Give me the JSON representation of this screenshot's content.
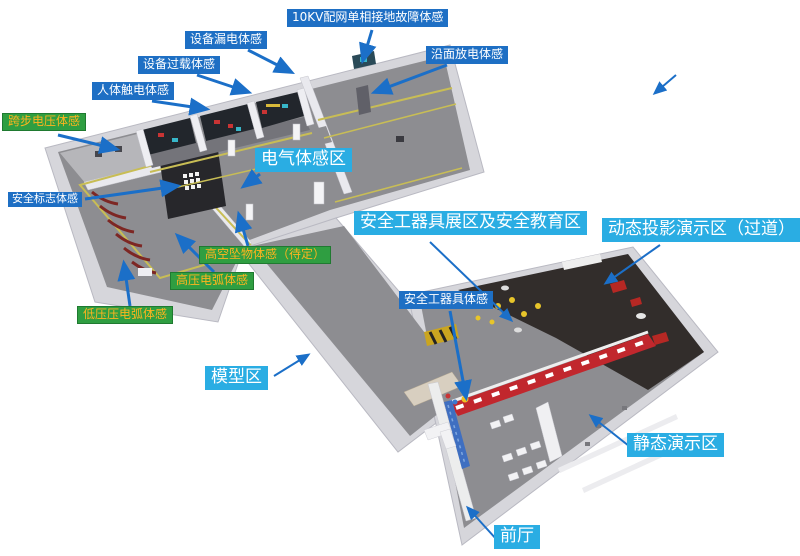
{
  "palette": {
    "label_blue": "#1e6fc4",
    "label_cyan": "#2aade3",
    "label_green": "#2f9e41",
    "green_label_text": "#ffb41e",
    "arrow_blue": "#1b6fc8",
    "floor_gray": "#8d8d91",
    "dark_floor": "#322d2b",
    "wall_white": "#d6d6db",
    "red_display_wall": "#c1272d",
    "floor_line_yellow": "#c8bd55"
  },
  "labels": {
    "kv10_fault": {
      "text": "10KV配网单相接地故障体感",
      "type": "blue"
    },
    "equipment_leakage": {
      "text": "设备漏电体感",
      "type": "blue"
    },
    "equipment_overload": {
      "text": "设备过载体感",
      "type": "blue"
    },
    "human_electric_shock": {
      "text": "人体触电体感",
      "type": "blue"
    },
    "surface_discharge": {
      "text": "沿面放电体感",
      "type": "blue"
    },
    "step_voltage": {
      "text": "跨步电压体感",
      "type": "green"
    },
    "safety_sign": {
      "text": "安全标志体感",
      "type": "blue"
    },
    "electric_zone": {
      "text": "电气体感区",
      "type": "cyan"
    },
    "falling_object": {
      "text": "高空坠物体感（待定）",
      "type": "green"
    },
    "high_voltage_arc": {
      "text": "高压电弧体感",
      "type": "green"
    },
    "low_voltage_arc": {
      "text": "低压压电弧体感",
      "type": "green"
    },
    "tools_exhibition_zone": {
      "text": "安全工器具展区及安全教育区",
      "type": "cyan"
    },
    "dynamic_projection_zone": {
      "text": "动态投影演示区（过道）",
      "type": "cyan"
    },
    "safety_tools_exp": {
      "text": "安全工器具体感",
      "type": "blue"
    },
    "model_zone": {
      "text": "模型区",
      "type": "cyan"
    },
    "static_demo_zone": {
      "text": "静态演示区",
      "type": "cyan"
    },
    "front_hall": {
      "text": "前厅",
      "type": "cyan"
    }
  }
}
